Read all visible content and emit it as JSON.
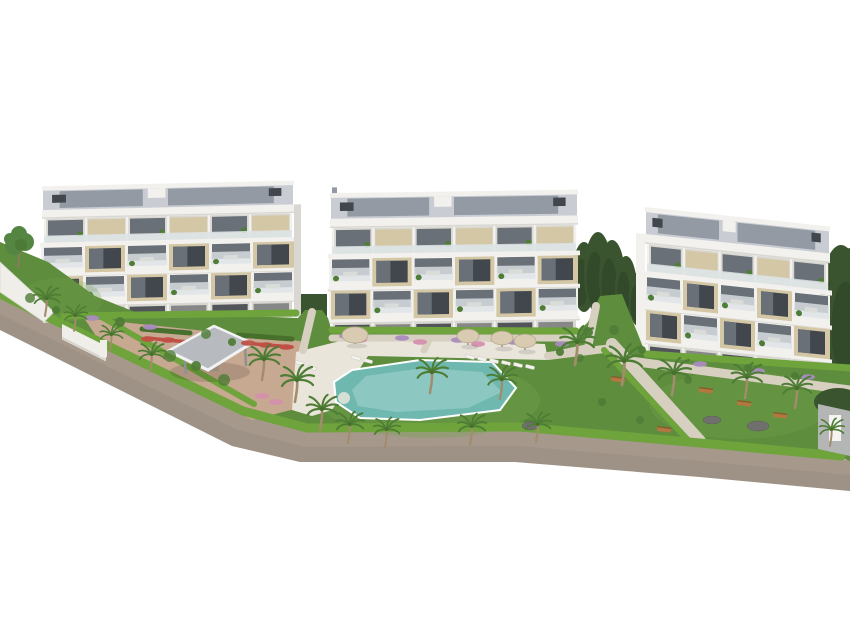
{
  "scene": {
    "type": "architectural-3d-rendering",
    "description": "Aerial 3D architectural rendering of a modern residential complex: three white four-storey apartment buildings with rooftop solar panels and glass balconies, landscaped communal gardens with palm trees and hedges, a turquoise swimming pool with sun loungers and parasols, a grey shade pavilion, an entrance gate and a perimeter access road, isolated on a plain white background",
    "building_count": 3
  },
  "palette": {
    "background": "#ffffff",
    "building_white": "#f2f1ed",
    "building_shadow": "#d9d7d1",
    "facade_beige": "#d4c7a5",
    "facade_beige_dark": "#bcab83",
    "window_glass": "#697077",
    "window_dark": "#41474c",
    "railing_glass": "#dde4e6",
    "roof_light": "#c9cdd3",
    "roof_panel": "#939aa3",
    "roof_white": "#eeedeb",
    "lawn_green": "#5e8d3d",
    "lawn_light": "#74a44c",
    "hedge_green": "#6fa33c",
    "hedge_dark": "#47702c",
    "conifer_green": "#3a5430",
    "shrub_green": "#4f7c36",
    "tree_green": "#558543",
    "palm_green": "#4e7d35",
    "palm_trunk": "#a28c6c",
    "road_gray": "#a6998c",
    "road_dark": "#8f8477",
    "curb_light": "#dad4ca",
    "path_beige": "#d7d0c1",
    "plaza_tan": "#c7a891",
    "pool_teal": "#6fb8b0",
    "pool_teal_light": "#a4d6cf",
    "pool_deck": "#e9e5db",
    "parasol_tan": "#d8cbb2",
    "lounger_white": "#f3f2ee",
    "canopy_gray": "#b7babf",
    "canopy_edge": "#f0f2f3",
    "flower_red": "#c04f46",
    "flower_pink": "#d58fae",
    "flower_purple": "#a98bc0",
    "bench_wood": "#b5763f",
    "rock_gray": "#6f6f6d",
    "wall_white": "#efeee9",
    "wall_gray": "#b4b6b5"
  },
  "buildings": [
    {
      "id": "building-left",
      "x": 42,
      "y": 189,
      "w": 252,
      "s": 0.88,
      "skew": -1.3,
      "modules": 6,
      "end_wall": "right",
      "chimney": false
    },
    {
      "id": "building-center",
      "x": 330,
      "y": 196,
      "w": 248,
      "s": 0.95,
      "skew": -0.8,
      "modules": 6,
      "end_wall": "",
      "chimney": true
    },
    {
      "id": "building-right",
      "x": 645,
      "y": 210,
      "w": 185,
      "s": 1.0,
      "skew": 6,
      "modules": 5,
      "end_wall": "left",
      "chimney": false
    }
  ],
  "landscape": {
    "palm_trees": [
      {
        "x": 45,
        "y": 316,
        "s": 0.8
      },
      {
        "x": 74,
        "y": 331,
        "s": 0.7
      },
      {
        "x": 110,
        "y": 350,
        "s": 0.7
      },
      {
        "x": 150,
        "y": 372,
        "s": 0.8
      },
      {
        "x": 262,
        "y": 380,
        "s": 0.95
      },
      {
        "x": 295,
        "y": 402,
        "s": 1.0
      },
      {
        "x": 320,
        "y": 430,
        "s": 0.95
      },
      {
        "x": 348,
        "y": 443,
        "s": 0.85
      },
      {
        "x": 385,
        "y": 447,
        "s": 0.8
      },
      {
        "x": 470,
        "y": 445,
        "s": 0.85
      },
      {
        "x": 536,
        "y": 442,
        "s": 0.8
      },
      {
        "x": 430,
        "y": 393,
        "s": 0.95
      },
      {
        "x": 500,
        "y": 399,
        "s": 0.9
      },
      {
        "x": 575,
        "y": 365,
        "s": 1.05
      },
      {
        "x": 622,
        "y": 385,
        "s": 1.1
      },
      {
        "x": 672,
        "y": 395,
        "s": 1.0
      },
      {
        "x": 745,
        "y": 398,
        "s": 0.95
      },
      {
        "x": 795,
        "y": 408,
        "s": 0.9
      },
      {
        "x": 830,
        "y": 446,
        "s": 0.75
      }
    ],
    "cypress_trees": [
      {
        "x": 584,
        "y": 312,
        "h": 70
      },
      {
        "x": 598,
        "y": 314,
        "h": 82
      },
      {
        "x": 612,
        "y": 316,
        "h": 76
      },
      {
        "x": 626,
        "y": 320,
        "h": 64
      },
      {
        "x": 638,
        "y": 326,
        "h": 54
      },
      {
        "x": 841,
        "y": 375,
        "h": 130
      },
      {
        "x": 851,
        "y": 388,
        "h": 140
      }
    ],
    "parasols": [
      {
        "x": 355,
        "y": 344,
        "r": 13
      },
      {
        "x": 468,
        "y": 345,
        "r": 11
      },
      {
        "x": 502,
        "y": 347,
        "r": 11
      },
      {
        "x": 525,
        "y": 350,
        "r": 11
      }
    ],
    "sun_loungers": [
      {
        "x": 356,
        "y": 358
      },
      {
        "x": 368,
        "y": 361
      },
      {
        "x": 300,
        "y": 363
      },
      {
        "x": 312,
        "y": 368
      },
      {
        "x": 470,
        "y": 357
      },
      {
        "x": 482,
        "y": 359
      },
      {
        "x": 494,
        "y": 361
      },
      {
        "x": 506,
        "y": 363
      },
      {
        "x": 518,
        "y": 365
      },
      {
        "x": 530,
        "y": 367
      }
    ],
    "benches": [
      {
        "x": 618,
        "y": 380
      },
      {
        "x": 664,
        "y": 430
      },
      {
        "x": 706,
        "y": 391
      },
      {
        "x": 744,
        "y": 404
      },
      {
        "x": 780,
        "y": 416
      }
    ],
    "rocks": [
      {
        "x": 712,
        "y": 420,
        "rx": 9,
        "ry": 4
      },
      {
        "x": 758,
        "y": 426,
        "rx": 11,
        "ry": 5
      },
      {
        "x": 530,
        "y": 426,
        "rx": 8,
        "ry": 4
      }
    ],
    "flower_beds": [
      {
        "x": 92,
        "y": 318,
        "c": "purple"
      },
      {
        "x": 150,
        "y": 327,
        "c": "purple"
      },
      {
        "x": 346,
        "y": 336,
        "c": "purple"
      },
      {
        "x": 402,
        "y": 338,
        "c": "purple"
      },
      {
        "x": 458,
        "y": 340,
        "c": "purple"
      },
      {
        "x": 514,
        "y": 342,
        "c": "purple"
      },
      {
        "x": 562,
        "y": 344,
        "c": "purple"
      },
      {
        "x": 700,
        "y": 364,
        "c": "purple"
      },
      {
        "x": 758,
        "y": 371,
        "c": "purple"
      },
      {
        "x": 808,
        "y": 377,
        "c": "purple"
      },
      {
        "x": 360,
        "y": 340,
        "c": "pink"
      },
      {
        "x": 420,
        "y": 342,
        "c": "pink"
      },
      {
        "x": 478,
        "y": 344,
        "c": "pink"
      },
      {
        "x": 262,
        "y": 396,
        "c": "pink"
      },
      {
        "x": 276,
        "y": 402,
        "c": "pink"
      },
      {
        "x": 148,
        "y": 339,
        "c": "red"
      },
      {
        "x": 168,
        "y": 340,
        "c": "red"
      },
      {
        "x": 248,
        "y": 343,
        "c": "red"
      },
      {
        "x": 266,
        "y": 345,
        "c": "red"
      },
      {
        "x": 286,
        "y": 347,
        "c": "red"
      }
    ],
    "shrubs": [
      {
        "x": 120,
        "y": 322,
        "r": 5
      },
      {
        "x": 206,
        "y": 334,
        "r": 5
      },
      {
        "x": 232,
        "y": 342,
        "r": 4
      },
      {
        "x": 30,
        "y": 298,
        "r": 5
      },
      {
        "x": 56,
        "y": 310,
        "r": 4
      },
      {
        "x": 170,
        "y": 356,
        "r": 6
      },
      {
        "x": 196,
        "y": 366,
        "r": 5
      },
      {
        "x": 224,
        "y": 380,
        "r": 6
      },
      {
        "x": 560,
        "y": 352,
        "r": 4
      },
      {
        "x": 580,
        "y": 358,
        "r": 4
      },
      {
        "x": 588,
        "y": 332,
        "r": 5
      },
      {
        "x": 614,
        "y": 330,
        "r": 5
      },
      {
        "x": 642,
        "y": 350,
        "r": 4
      },
      {
        "x": 748,
        "y": 368,
        "r": 4
      },
      {
        "x": 795,
        "y": 376,
        "r": 4
      },
      {
        "x": 640,
        "y": 420,
        "r": 4
      },
      {
        "x": 602,
        "y": 402,
        "r": 4
      },
      {
        "x": 688,
        "y": 380,
        "r": 4
      }
    ]
  }
}
